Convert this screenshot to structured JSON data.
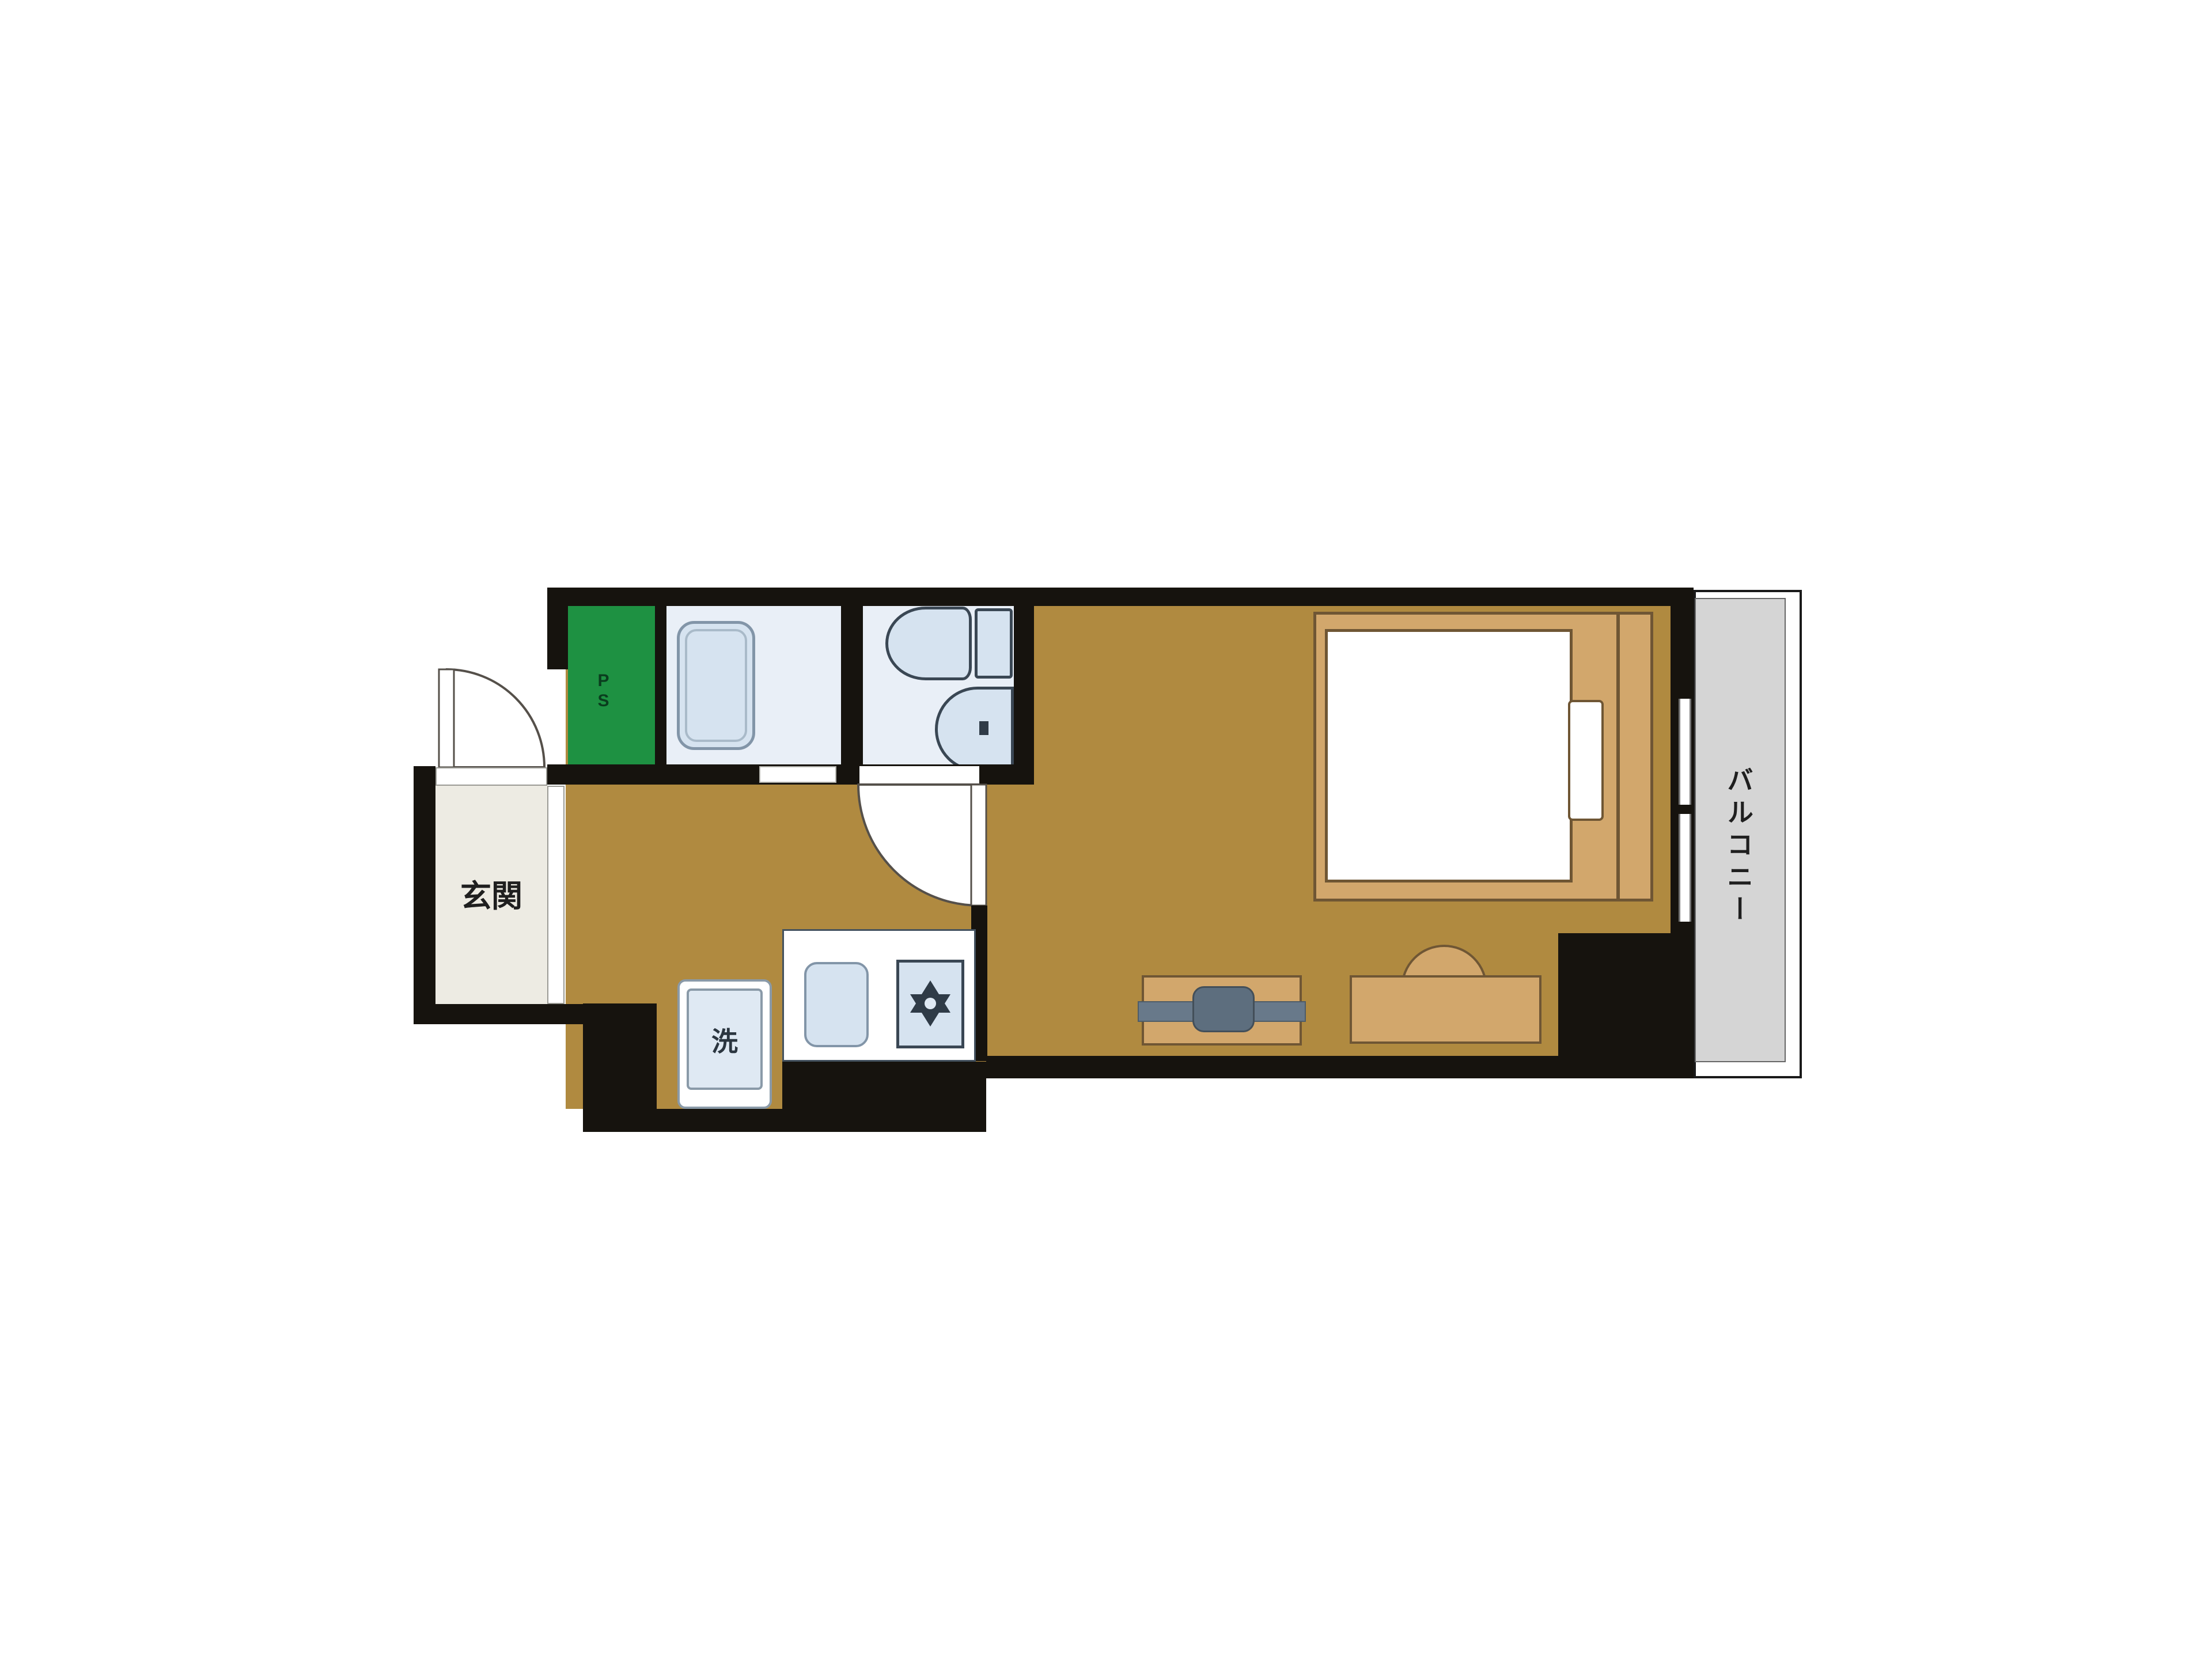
{
  "floorplan": {
    "labels": {
      "entrance": "玄関",
      "balcony": "バルコニー",
      "washing_machine": "洗",
      "pipe_space": "PS"
    },
    "colors": {
      "wall_black": "#16130e",
      "flooring_brown": "#b08a40",
      "furniture_tan": "#d2a76c",
      "furniture_outline": "#6f5634",
      "wet_room_floor": "#e9eff7",
      "fixture_fill": "#d6e3f0",
      "fixture_outline_light": "#8295a8",
      "fixture_outline_dark": "#3a4754",
      "pipe_space_green": "#1e9142",
      "entrance_floor_cream": "#edebe3",
      "balcony_gray": "#d5d5d5",
      "appliance_gray": "#68798a",
      "background": "#ffffff"
    }
  }
}
